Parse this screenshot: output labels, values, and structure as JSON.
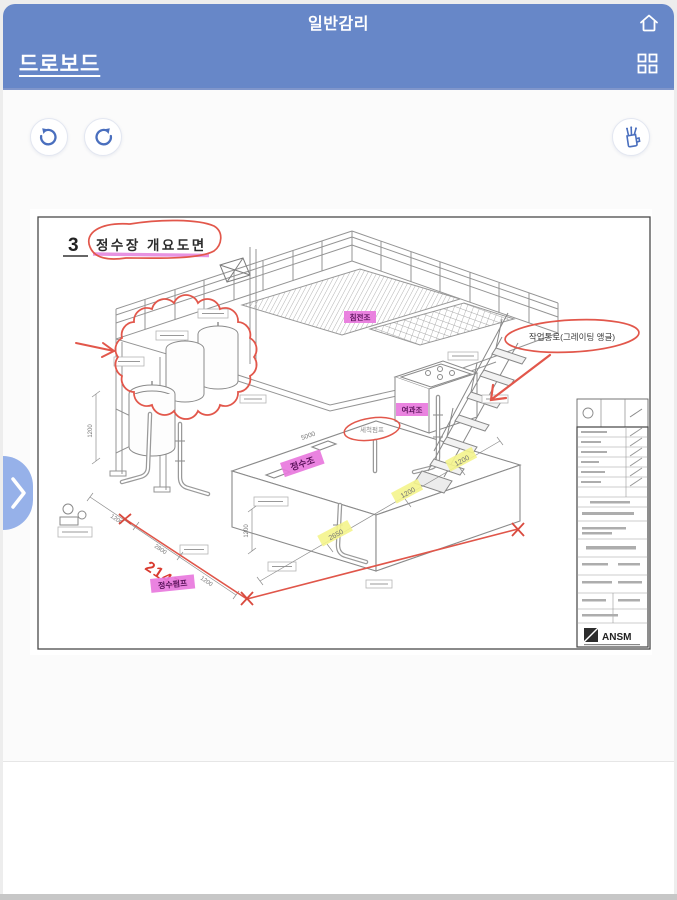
{
  "app": {
    "title": "일반감리",
    "nav_label": "드로보드"
  },
  "icons": {
    "home": "home-icon",
    "grid": "grid-menu-icon",
    "undo": "undo-arrow-icon",
    "redo": "redo-arrow-icon",
    "pen_tray": "pen-holder-icon",
    "drawer": "chevron-right-icon"
  },
  "drawing": {
    "sheet_no": "3",
    "title": "정수장 개요도면",
    "passage_note": "작업통로(그레이팅 앵글)",
    "handwritten_dim": "2147",
    "logo_text": "ANSM",
    "labels": [
      {
        "text": "침전조"
      },
      {
        "text": "여과조"
      },
      {
        "text": "정수조"
      },
      {
        "text": "정수펌프"
      },
      {
        "text": "세척펌프"
      }
    ],
    "dims": [
      {
        "text": "1200"
      },
      {
        "text": "1200"
      },
      {
        "text": "2650"
      },
      {
        "text": "5000"
      },
      {
        "text": "1200"
      },
      {
        "text": "1200"
      },
      {
        "text": "2800"
      },
      {
        "text": "1200"
      },
      {
        "text": "1200"
      }
    ]
  },
  "colors": {
    "header_blue": "#6787c8",
    "icon_blue": "#4a6fbe",
    "annotation_red": "#e2574b",
    "highlight_magenta": "#e878dd",
    "highlight_yellow": "#f4f48c"
  }
}
